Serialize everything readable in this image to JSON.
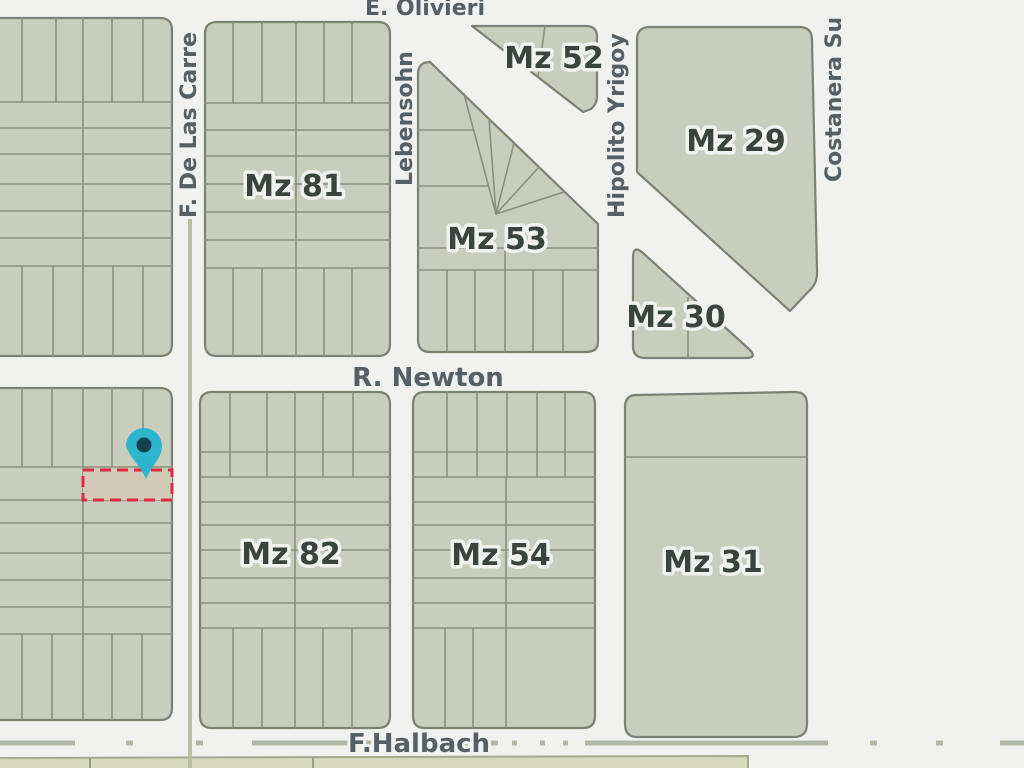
{
  "map": {
    "kind": "cadastral-parcel-map",
    "streets": {
      "e_olivieri": "E. Olivieri",
      "f_de_las_carreras": "F. De Las Carre",
      "lebensohn": "Lebensohn",
      "hipolito_yrigoyen": "Hipolito Yrigoy",
      "costanera_sur": "Costanera Su",
      "r_newton": "R. Newton",
      "f_halbach": "F.Halbach"
    },
    "blocks": {
      "mz81": "Mz 81",
      "mz52": "Mz 52",
      "mz29": "Mz 29",
      "mz53": "Mz 53",
      "mz30": "Mz 30",
      "mz82": "Mz 82",
      "mz54": "Mz 54",
      "mz31": "Mz 31"
    },
    "marker": {
      "type": "location-pin",
      "color_hex": "#2cb5cd"
    },
    "highlighted_parcel": {
      "outline": "red-dashed",
      "color_hex": "#e02940"
    },
    "colors": {
      "street_bg": "#f1f2ef",
      "block_fill": "#c9cdbb",
      "block_stroke": "#7b8173",
      "lot_stroke": "#8a9080",
      "label_dark": "#39443c",
      "street_label": "#556066",
      "median_green": "#b6c19c",
      "pin": "#2cb5cd",
      "pin_core": "#16414c",
      "highlight_red": "#e02940"
    }
  }
}
